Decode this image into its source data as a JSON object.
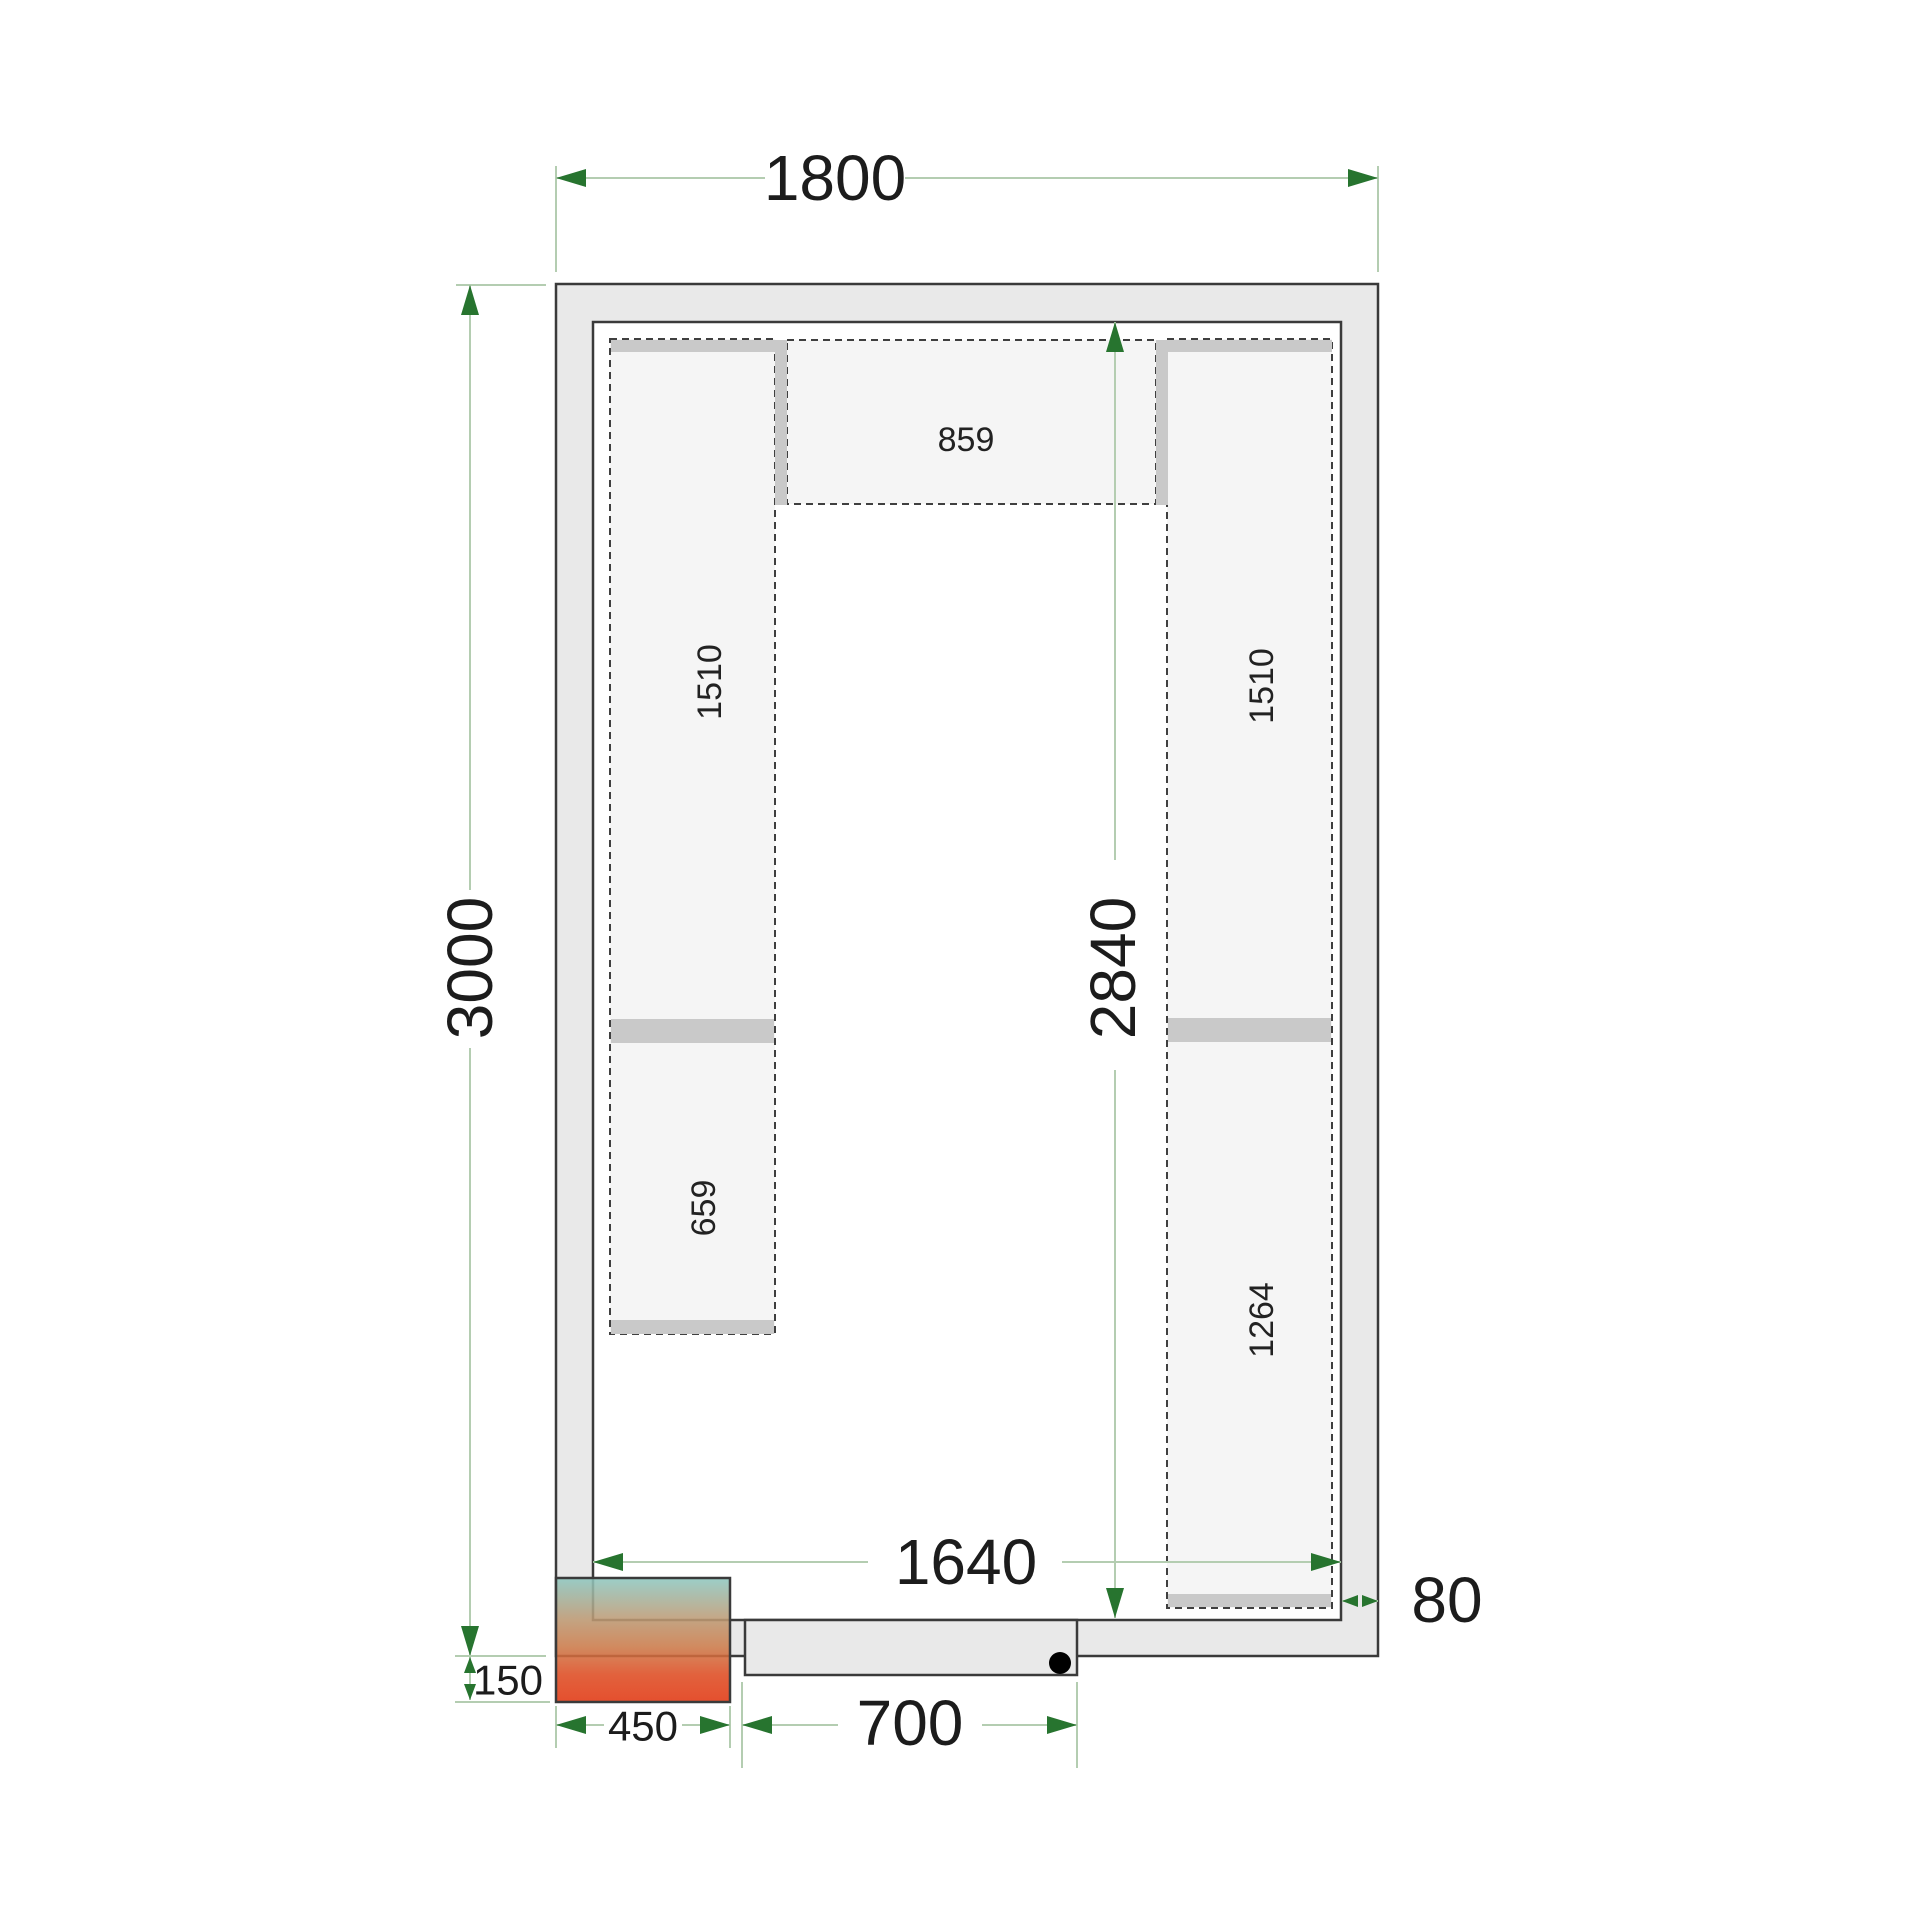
{
  "drawing": {
    "title": "cold-room floor plan with shelving",
    "dimensions": {
      "outer_width": "1800",
      "outer_depth": "3000",
      "inner_width": "1640",
      "inner_depth": "2840",
      "wall_thickness": "80",
      "unit_width": "450",
      "unit_protrusion": "150",
      "door_width": "700"
    },
    "shelves": {
      "back_shelf": "859",
      "left_upper": "1510",
      "left_lower": "659",
      "right_upper": "1510",
      "right_lower": "1264"
    },
    "colors": {
      "wall_fill": "#e9e9e9",
      "interior_fill": "#ffffff",
      "outline": "#3a3a3a",
      "shelf_fill": "#f5f5f5",
      "shelf_dash": "#3f3f3f",
      "bracket_fill": "#c9c9c9",
      "dim_line": "#b4cdb1",
      "dim_arrow": "#27742f",
      "label_text": "#1c1c1c",
      "unit_teal": "#8cc7c0",
      "unit_tan": "#bd9a74",
      "unit_orange": "#cd7d4c",
      "unit_red": "#e1350f"
    }
  }
}
